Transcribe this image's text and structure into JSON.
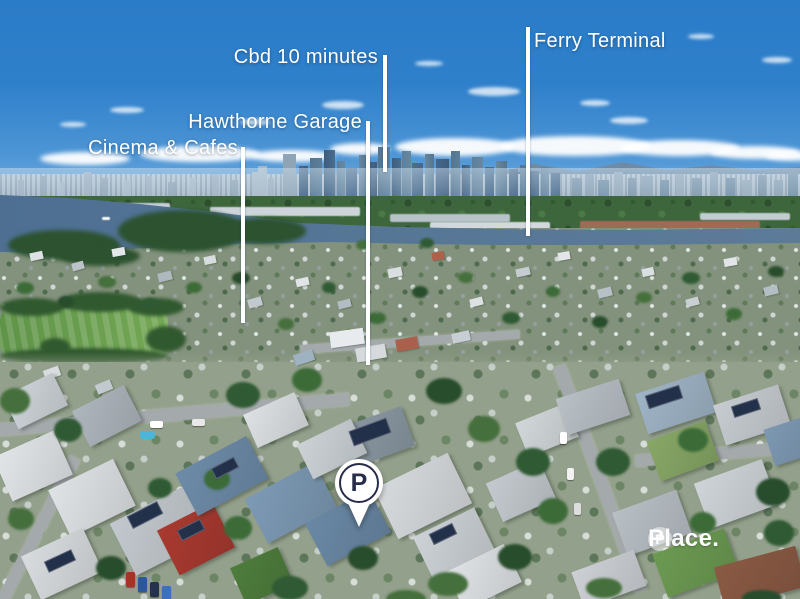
{
  "annotations": {
    "ferry": {
      "text": "Ferry Terminal"
    },
    "cbd": {
      "text": "Cbd 10 minutes"
    },
    "garage": {
      "text": "Hawthorne Garage"
    },
    "cinema": {
      "text": "Cinema & Cafes"
    }
  },
  "marker": {
    "letter": "P"
  },
  "watermark": {
    "brand": "Place.",
    "logo_letter": "P"
  },
  "palette": {
    "sky_top": "#2b7cc8",
    "sky_horizon": "#c7ddee",
    "river": "#54759a",
    "annotation_text": "#ffffff",
    "marker_navy": "#272c49",
    "park_green": "#6aa050",
    "red_roof": "#a93a30"
  }
}
